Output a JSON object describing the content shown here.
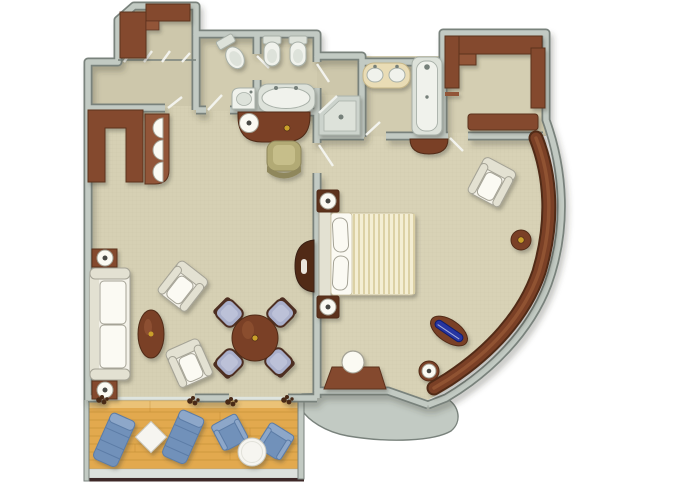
{
  "scene": {
    "description": "Top-down 3D rendered floor plan of a suite: entry hall with wardrobe, guest toilet, bathroom with whirlpool tub, shower room, master bathroom with double vanity and bathtub, walk-in closet, living room with bar and dining table, bedroom with double bed along a curved outer wall, and a furnished wood-deck balcony",
    "view": "top-down floor plan, no text labels"
  },
  "palette": {
    "background": "#ffffff",
    "wallFill": "#c2cac3",
    "wallEdge": "#79827c",
    "doorTick": "#f4f6f1",
    "carpetLiving": "#d6d0b4",
    "carpetBedroom": "#d8d2b6",
    "carpetHall": "#cdc7ab",
    "carpetBath": "#d2ccb0",
    "carpetCloset": "#d4ceb2",
    "wood": "#84482e",
    "woodDark": "#5b301e",
    "woodMid": "#925437",
    "mahog": "#7a4026",
    "mahogDark": "#512c19",
    "mahogHi": "#9a5a38",
    "uphWhite": "#f3f1e8",
    "uphShade": "#e3e1d2",
    "linen": "#fbfaf3",
    "furnStroke": "#a5a396",
    "duvet": "#f4eed3",
    "duvetStripe": "#dcd1a5",
    "fixWhite": "#f0f2ec",
    "fixInner": "#dde2da",
    "fixStroke": "#a8b0a8",
    "showerTray": "#ccd3cc",
    "metal": "#76807a",
    "counterCream": "#e9dcb5",
    "counterEdge": "#c7b789",
    "diningSeat": "#a9afcb",
    "chairFrame": "#4e2f20",
    "olive": "#b2aa75",
    "oliveDark": "#8f875b",
    "oliveLight": "#c6be8a",
    "balcBlue": "#7191ba",
    "balcBlueDark": "#5c7ca6",
    "balcBlueLight": "#8da7c9",
    "deckWood": "#e2a94e",
    "deckLine": "#b9852f",
    "deckTop": "#efcf8d",
    "deckRail": "#3d2827",
    "railBand": "#dde1dc",
    "glassBlue": "#2636a2",
    "glassBlueDark": "#101c6e",
    "brass": "#c9a02c",
    "lampDot": "#4a4a44",
    "curtain": "#4a2a18",
    "tableWhite": "#f6f5f0",
    "tableStroke": "#c9c9c0",
    "weave": "#8a8468"
  },
  "rooms": [
    {
      "name": "entry-hall",
      "furniture": [
        "wardrobe-cabinet",
        "sliding-closet-doors"
      ]
    },
    {
      "name": "guest-toilet",
      "furniture": [
        "toilet",
        "corner-basin"
      ]
    },
    {
      "name": "bathroom",
      "furniture": [
        "wall-hung-toilet",
        "bidet",
        "whirlpool-tub"
      ]
    },
    {
      "name": "shower-room",
      "furniture": [
        "corner-shower"
      ]
    },
    {
      "name": "master-bathroom",
      "furniture": [
        "double-sink-vanity",
        "bathtub"
      ]
    },
    {
      "name": "walk-in-closet",
      "furniture": [
        "upper-cabinet",
        "tall-cabinet",
        "side-cabinet",
        "bench"
      ]
    },
    {
      "name": "living-room",
      "furniture": [
        "bar-counter",
        "bar-stools",
        "writing-desk",
        "desk-lamp",
        "desk-chair",
        "sofa",
        "side-tables",
        "table-lamps",
        "oval-coffee-table",
        "armchairs",
        "round-dining-table",
        "dining-chairs",
        "half-moon-console",
        "curtains",
        "sliding-glass-doors"
      ]
    },
    {
      "name": "bedroom",
      "furniture": [
        "double-bed",
        "headboard",
        "nightstands",
        "bedside-lamps",
        "armchair",
        "dressing-table",
        "dressing-stool",
        "curved-window-ledge",
        "brass-knob",
        "blue-glass-inlay",
        "ledge-lamp",
        "half-moon-shelf"
      ]
    },
    {
      "name": "balcony",
      "furniture": [
        "wood-deck",
        "sun-loungers",
        "diamond-side-table",
        "lounge-chairs",
        "round-table",
        "railing"
      ]
    }
  ]
}
